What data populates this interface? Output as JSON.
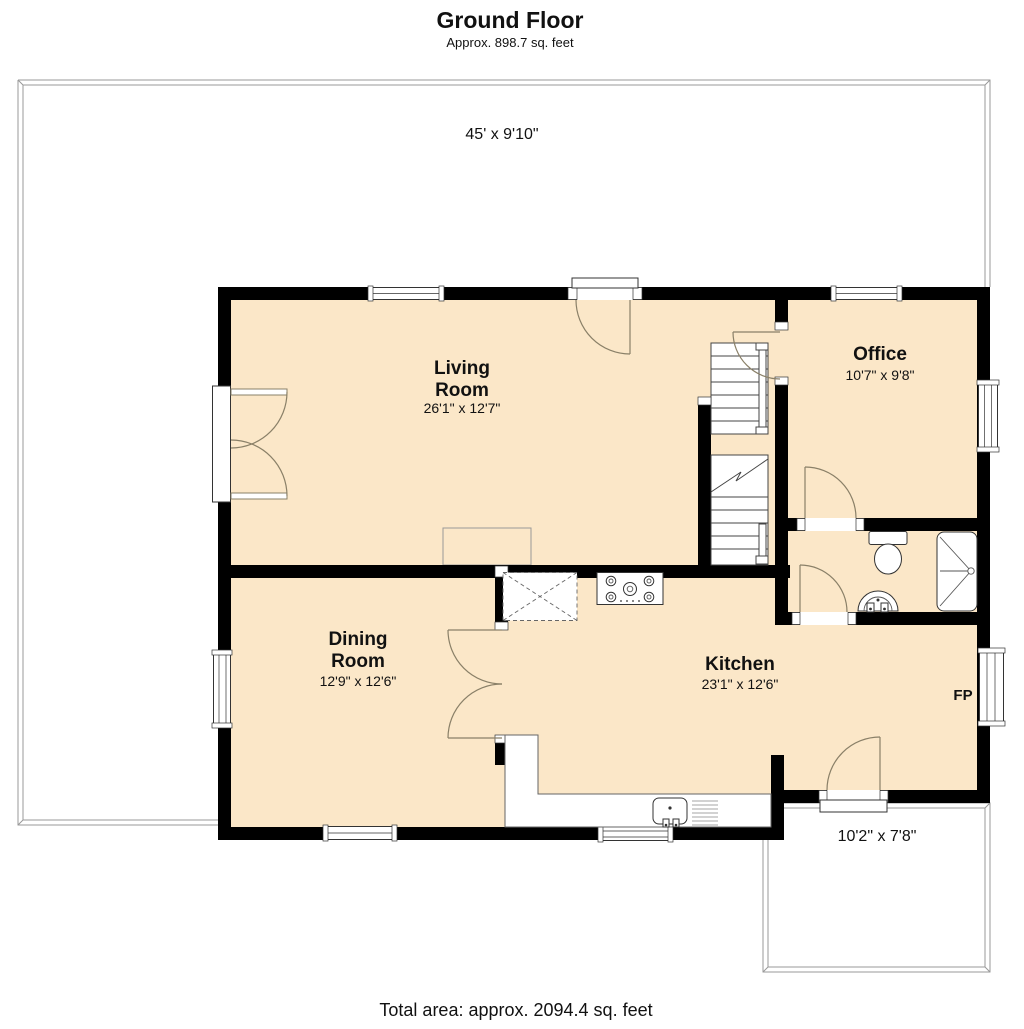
{
  "header": {
    "title": "Ground Floor",
    "subtitle": "Approx. 898.7 sq. feet"
  },
  "footer": {
    "total_area": "Total area: approx. 2094.4 sq. feet"
  },
  "deck": {
    "dimensions": "45' x 9'10\""
  },
  "rooms": {
    "living": {
      "name_lines": [
        "Living",
        "Room"
      ],
      "dimensions": "26'1\" x 12'7\""
    },
    "dining": {
      "name_lines": [
        "Dining",
        "Room"
      ],
      "dimensions": "12'9\" x 12'6\""
    },
    "kitchen": {
      "name_lines": [
        "Kitchen"
      ],
      "dimensions": "23'1\" x 12'6\""
    },
    "office": {
      "name_lines": [
        "Office"
      ],
      "dimensions": "10'7\" x 9'8\""
    },
    "rear_porch": {
      "dimensions": "10'2\" x 7'8\""
    }
  },
  "labels": {
    "fireplace": "FP"
  },
  "colors": {
    "floor_fill": "#FBE7C8",
    "wall": "#000000",
    "thin_outline": "#999999",
    "door_arc": "#8a8068",
    "fixture_outline": "#333333"
  }
}
